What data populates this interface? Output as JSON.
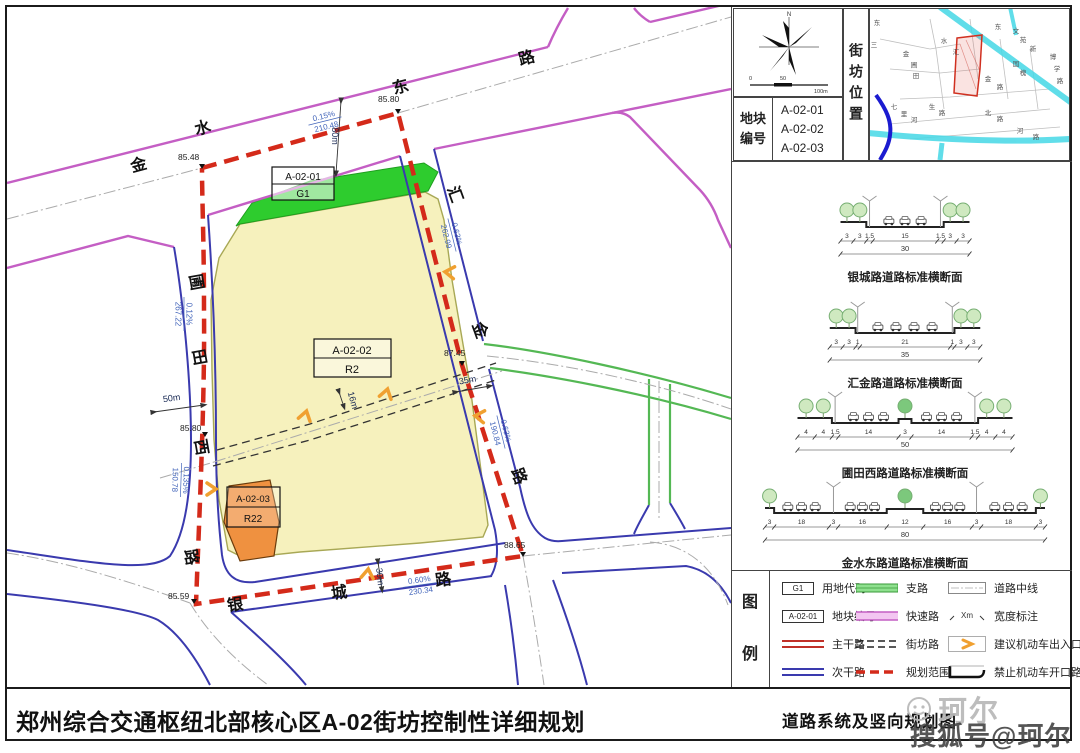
{
  "titles": {
    "main": "郑州综合交通枢纽北部核心区A-02街坊控制性详细规划",
    "drawing": "道路系统及竖向规划图"
  },
  "watermark": {
    "light": "珂尔",
    "dark": "搜狐号@珂尔"
  },
  "panel": {
    "north": "N",
    "scale_ticks": [
      "0",
      "50",
      "100m"
    ],
    "block_no_label": "地块编号",
    "block_numbers": [
      "A-02-01",
      "A-02-02",
      "A-02-03"
    ],
    "location_label": "街坊位置",
    "inset_labels": [
      {
        "t": "东",
        "x": 7,
        "y": 16
      },
      {
        "t": "三",
        "x": 4,
        "y": 38
      },
      {
        "t": "金",
        "x": 36,
        "y": 47
      },
      {
        "t": "圃",
        "x": 44,
        "y": 58
      },
      {
        "t": "田",
        "x": 46,
        "y": 69
      },
      {
        "t": "水",
        "x": 74,
        "y": 34
      },
      {
        "t": "汇",
        "x": 86,
        "y": 45
      },
      {
        "t": "东",
        "x": 128,
        "y": 20
      },
      {
        "t": "文",
        "x": 146,
        "y": 24
      },
      {
        "t": "苑",
        "x": 153,
        "y": 33
      },
      {
        "t": "新",
        "x": 163,
        "y": 42
      },
      {
        "t": "国",
        "x": 146,
        "y": 57
      },
      {
        "t": "槐",
        "x": 153,
        "y": 66
      },
      {
        "t": "博",
        "x": 183,
        "y": 50
      },
      {
        "t": "学",
        "x": 187,
        "y": 62
      },
      {
        "t": "路",
        "x": 190,
        "y": 74
      },
      {
        "t": "金",
        "x": 118,
        "y": 72
      },
      {
        "t": "路",
        "x": 130,
        "y": 80
      },
      {
        "t": "七",
        "x": 24,
        "y": 100
      },
      {
        "t": "里",
        "x": 34,
        "y": 107
      },
      {
        "t": "河",
        "x": 44,
        "y": 113
      },
      {
        "t": "生",
        "x": 62,
        "y": 100
      },
      {
        "t": "路",
        "x": 72,
        "y": 106
      },
      {
        "t": "北",
        "x": 118,
        "y": 106
      },
      {
        "t": "路",
        "x": 130,
        "y": 112
      },
      {
        "t": "河",
        "x": 150,
        "y": 124
      },
      {
        "t": "路",
        "x": 166,
        "y": 130
      }
    ]
  },
  "sections": [
    {
      "caption": "银城路道路标准横断面",
      "widths": [
        "3",
        "3",
        "1.5",
        "15",
        "1.5",
        "3",
        "3"
      ],
      "roles": [
        "s",
        "s",
        "x",
        "c",
        "x",
        "s",
        "s"
      ],
      "total": "30"
    },
    {
      "caption": "汇金路道路标准横断面",
      "widths": [
        "3",
        "3",
        "1",
        "21",
        "1",
        "3",
        "3"
      ],
      "roles": [
        "s",
        "s",
        "x",
        "c",
        "x",
        "s",
        "s"
      ],
      "total": "35"
    },
    {
      "caption": "圃田西路道路标准横断面",
      "widths": [
        "4",
        "4",
        "1.5",
        "14",
        "3",
        "14",
        "1.5",
        "4",
        "4"
      ],
      "roles": [
        "s",
        "s",
        "x",
        "c",
        "m",
        "c",
        "x",
        "s",
        "s"
      ],
      "total": "50"
    },
    {
      "caption": "金水东路道路标准横断面",
      "widths": [
        "3",
        "18",
        "3",
        "16",
        "12",
        "16",
        "3",
        "18",
        "3"
      ],
      "roles": [
        "s",
        "c",
        "x",
        "c",
        "m",
        "c",
        "x",
        "c",
        "s"
      ],
      "total": "80"
    }
  ],
  "legend": {
    "title_chars": [
      "图",
      "例"
    ],
    "g1_text": "G1",
    "block_text": "A-02-01",
    "width_text": "Xm",
    "items": [
      "用地代码",
      "地块编号",
      "主干路",
      "次干路",
      "支路",
      "快速路",
      "街坊路",
      "规划范围",
      "道路中线",
      "宽度标注",
      "建议机动车出入口",
      "禁止机动车开口路段"
    ]
  },
  "map": {
    "blocks": [
      {
        "code": "A-02-01",
        "use": "G1"
      },
      {
        "code": "A-02-02",
        "use": "R2"
      },
      {
        "code": "A-02-03",
        "use": "R22"
      }
    ],
    "road_chars": [
      {
        "t": "金",
        "x": 140,
        "y": 170,
        "r": -15
      },
      {
        "t": "水",
        "x": 204,
        "y": 133,
        "r": -15
      },
      {
        "t": "东",
        "x": 402,
        "y": 92,
        "r": -15
      },
      {
        "t": "路",
        "x": 528,
        "y": 63,
        "r": -15
      },
      {
        "t": "汇",
        "x": 450,
        "y": 196,
        "r": 70
      },
      {
        "t": "金",
        "x": 475,
        "y": 332,
        "r": 70
      },
      {
        "t": "路",
        "x": 514,
        "y": 478,
        "r": 70
      },
      {
        "t": "圃",
        "x": 191,
        "y": 283,
        "r": 80
      },
      {
        "t": "田",
        "x": 194,
        "y": 358,
        "r": 80
      },
      {
        "t": "西",
        "x": 196,
        "y": 448,
        "r": 80
      },
      {
        "t": "路",
        "x": 186,
        "y": 558,
        "r": 80
      },
      {
        "t": "银",
        "x": 236,
        "y": 610,
        "r": -8
      },
      {
        "t": "城",
        "x": 340,
        "y": 598,
        "r": -8
      },
      {
        "t": "路",
        "x": 444,
        "y": 585,
        "r": -8
      }
    ],
    "elevations": [
      {
        "t": "85.48",
        "x": 178,
        "y": 160
      },
      {
        "t": "85.80",
        "x": 378,
        "y": 102
      },
      {
        "t": "87.45",
        "x": 444,
        "y": 356
      },
      {
        "t": "85.80",
        "x": 180,
        "y": 431
      },
      {
        "t": "85.59",
        "x": 168,
        "y": 599
      },
      {
        "t": "88.65",
        "x": 504,
        "y": 548
      }
    ],
    "widths": [
      {
        "t": "80m",
        "x": 332,
        "y": 136,
        "r": 90
      },
      {
        "t": "50m",
        "x": 172,
        "y": 401,
        "r": -8
      },
      {
        "t": "35m",
        "x": 468,
        "y": 383,
        "r": -10
      },
      {
        "t": "30m",
        "x": 377,
        "y": 577,
        "r": 84
      },
      {
        "t": "16m",
        "x": 350,
        "y": 401,
        "r": 74
      }
    ],
    "slopes": [
      {
        "g": "0.15%",
        "l": "210.48",
        "x": 325,
        "y": 121,
        "r": -14
      },
      {
        "g": "0.63%",
        "l": "262.99",
        "x": 452,
        "y": 235,
        "r": 76
      },
      {
        "g": "0.63%",
        "l": "190.84",
        "x": 501,
        "y": 432,
        "r": 76
      },
      {
        "g": "0.12%",
        "l": "267.22",
        "x": 184,
        "y": 314,
        "r": 90
      },
      {
        "g": "0.135%",
        "l": "150.78",
        "x": 181,
        "y": 480,
        "r": 92
      },
      {
        "g": "0.60%",
        "l": "230.34",
        "x": 420,
        "y": 585,
        "r": -8
      }
    ]
  }
}
